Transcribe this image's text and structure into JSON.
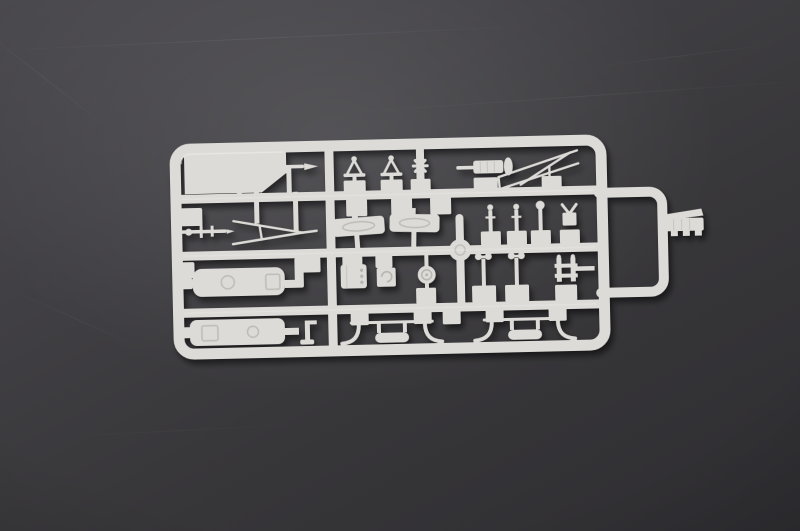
{
  "scene": {
    "type": "photograph",
    "description": "Light grey injection-moulded plastic model kit sprue (ship fittings parts tree) lying on a dark grey scratched surface",
    "background": {
      "surface_color_top_left": "#4a494d",
      "surface_color_bottom_right": "#2e2d31",
      "scratch_color": "#9a9a9e"
    },
    "sprue": {
      "plastic_color": "#dcdbd7",
      "plastic_highlight": "#f2f1ee",
      "plastic_shade": "#b7b6b1",
      "frame": {
        "rows": 4,
        "columns": 3,
        "right_extension_loop": true,
        "corner_tab": true
      },
      "parts": [
        {
          "name": "yardarm-antenna",
          "qty": 1
        },
        {
          "name": "tripod-lamp-mast",
          "qty": 2
        },
        {
          "name": "cross-fitting",
          "qty": 1
        },
        {
          "name": "searchlight-cylinder",
          "qty": 1
        },
        {
          "name": "a-frame-yard",
          "qty": 1
        },
        {
          "name": "small-deck-gun",
          "qty": 1
        },
        {
          "name": "a-frame-mast",
          "qty": 1
        },
        {
          "name": "engraved-deck-plate",
          "qty": 2
        },
        {
          "name": "ball-top-stanchion",
          "qty": 3
        },
        {
          "name": "v-notch-bracket",
          "qty": 1
        },
        {
          "name": "deckhouse-box",
          "qty": 2
        },
        {
          "name": "cable-drum",
          "qty": 1
        },
        {
          "name": "spiral-capstan-box",
          "qty": 1
        },
        {
          "name": "range-finder-dial",
          "qty": 1
        },
        {
          "name": "twin-ball-anemometer",
          "qty": 2
        },
        {
          "name": "h-frame-bollard",
          "qty": 1
        },
        {
          "name": "davit-cradle-set",
          "qty": 2
        },
        {
          "name": "ribbed-hull-bracket",
          "qty": 1
        },
        {
          "name": "injection-hub",
          "qty": 1
        },
        {
          "name": "corner-tab",
          "qty": 1
        },
        {
          "name": "edge-tab",
          "qty": 2
        },
        {
          "name": "sprue-gate-pad",
          "qty": 22
        }
      ]
    }
  }
}
